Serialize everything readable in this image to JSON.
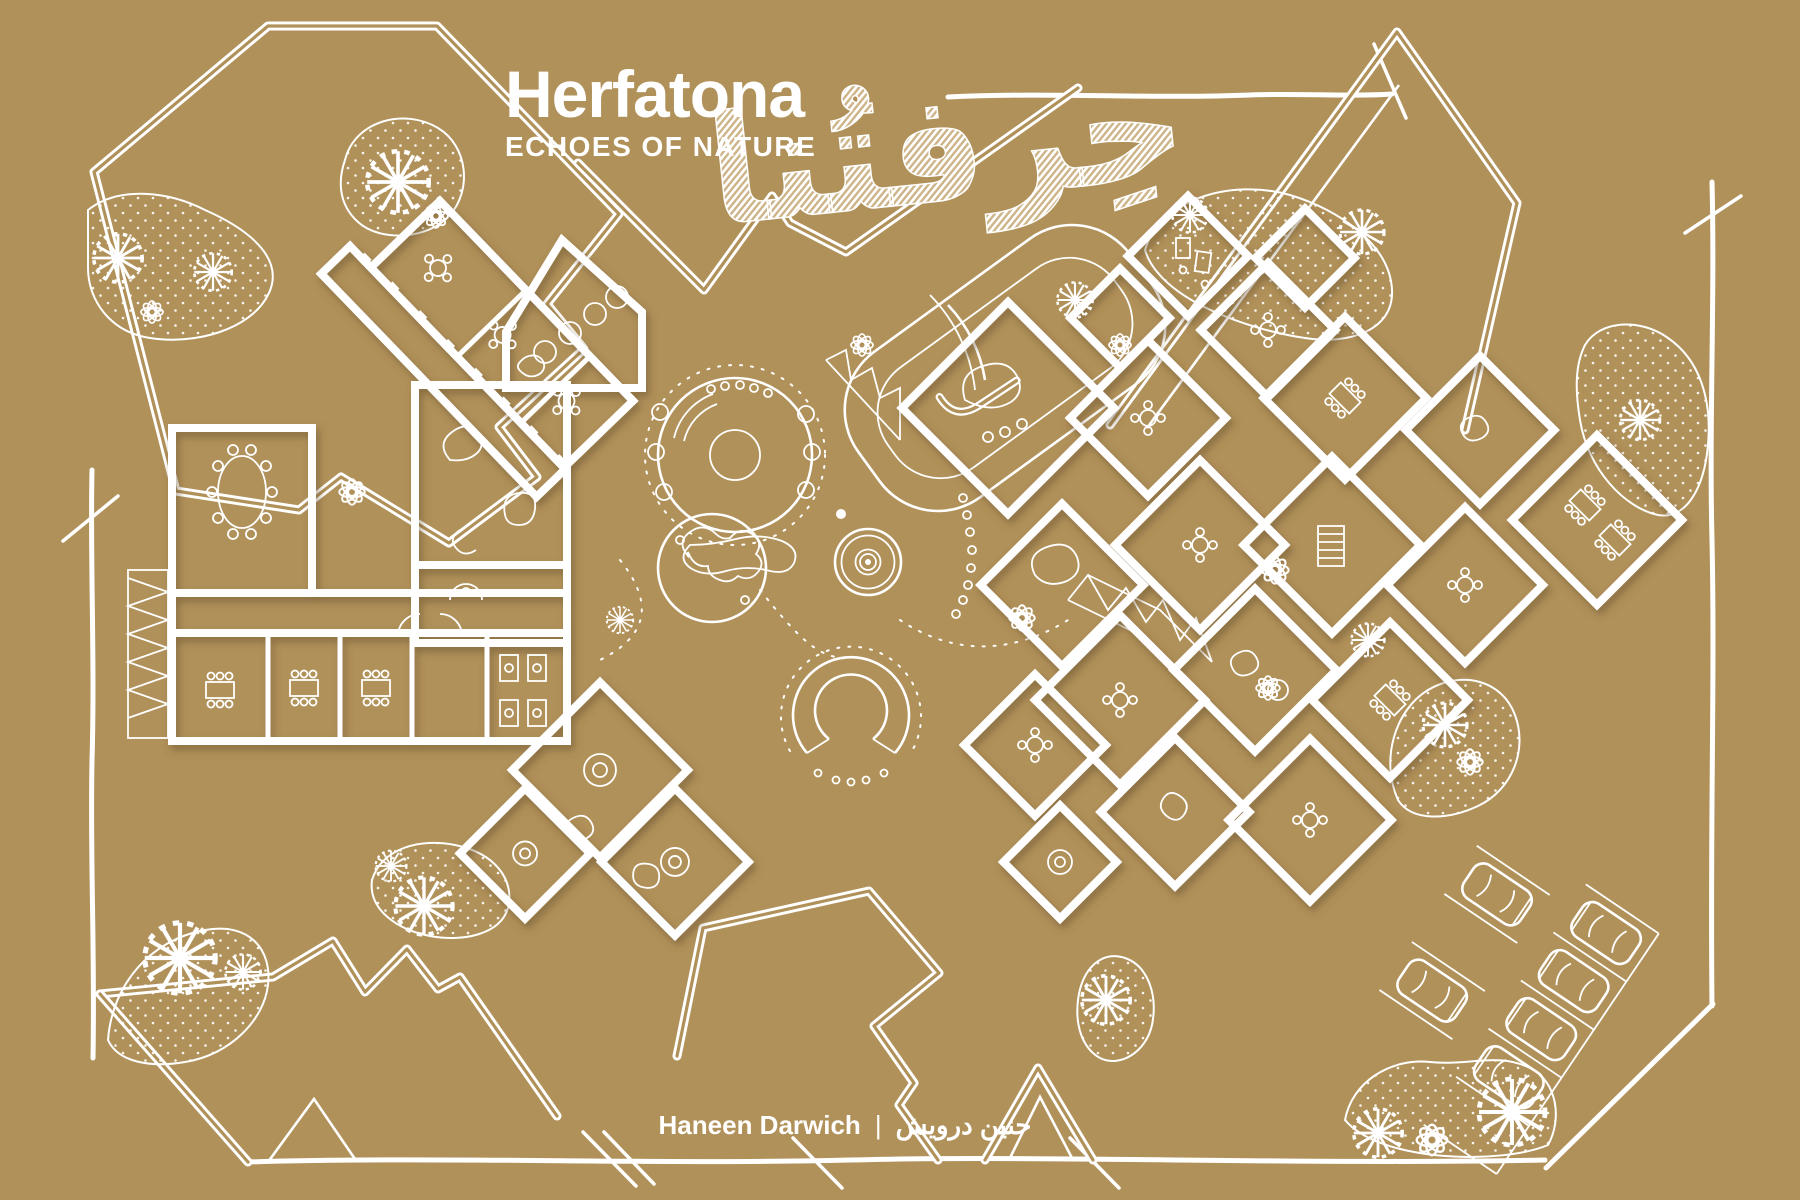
{
  "palette": {
    "background": "#b1915a",
    "line": "#ffffff"
  },
  "header": {
    "title": "Herfatona",
    "subtitle": "ECHOES OF NATURE",
    "calligraphy_ar": "حِرفتُنا"
  },
  "footer": {
    "author": "Haneen Darwich",
    "separator": "|",
    "author_ar": "حنين درويش"
  }
}
